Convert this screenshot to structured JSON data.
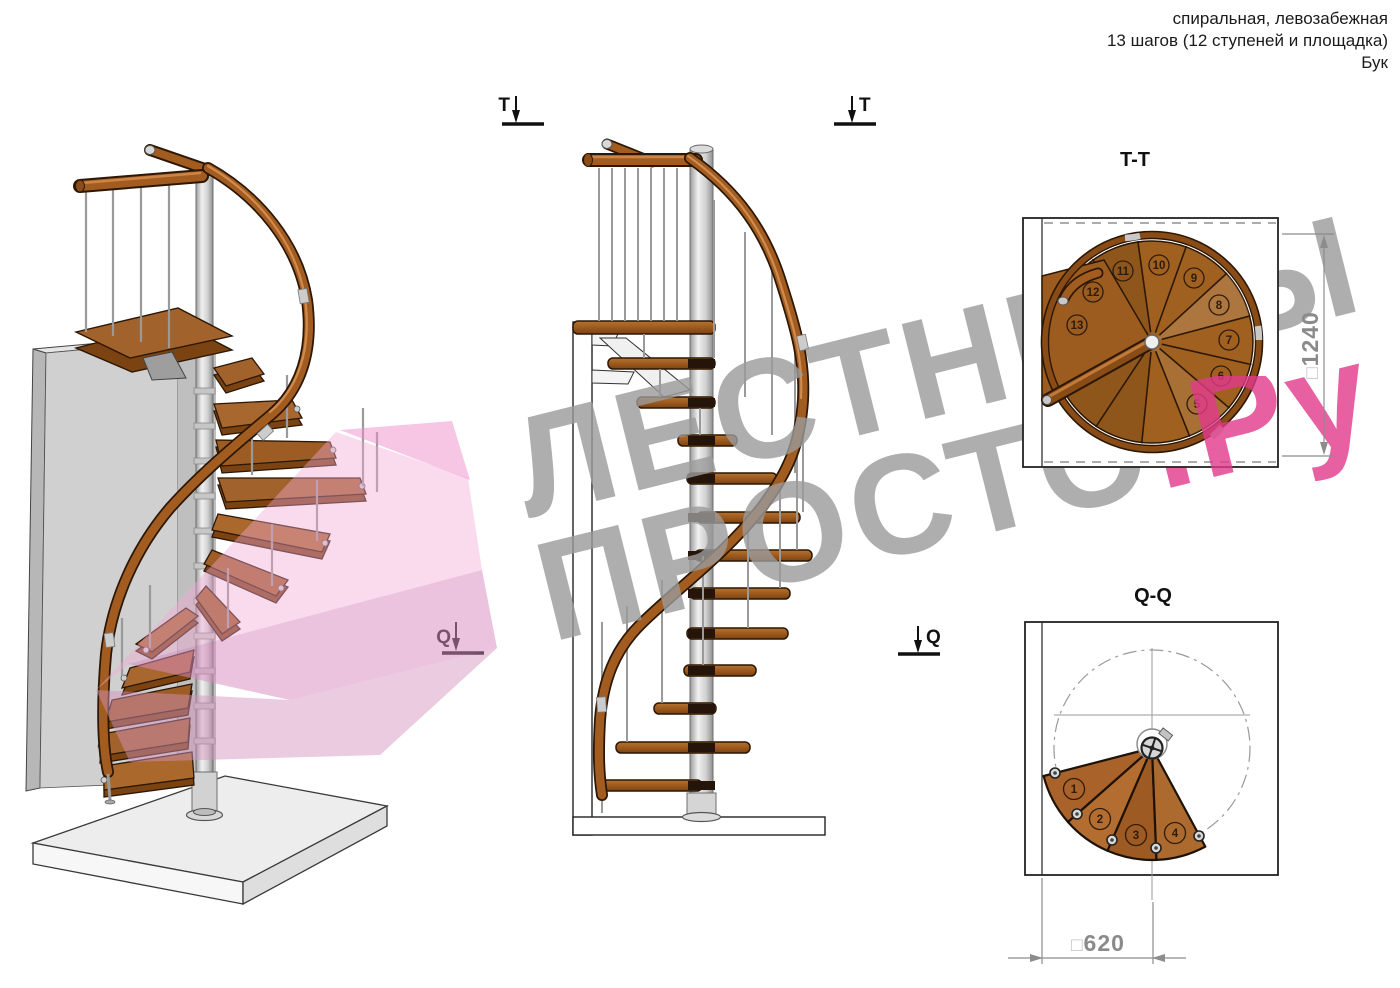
{
  "header": {
    "line1": "спиральная, левозабежная",
    "line2": "13 шагов (12 ступеней и площадка)",
    "line3": "Бук"
  },
  "views": {
    "tt_title": "T-T",
    "qq_title": "Q-Q"
  },
  "markers": {
    "t": "T",
    "q": "Q"
  },
  "dimensions": {
    "square_symbol": "□",
    "tt_value": "1240",
    "qq_value": "620"
  },
  "plan_tt": {
    "step_numbers": [
      "5",
      "6",
      "7",
      "8",
      "9",
      "10",
      "11",
      "12",
      "13"
    ]
  },
  "plan_qq": {
    "step_numbers": [
      "1",
      "2",
      "3",
      "4"
    ]
  },
  "watermark": {
    "line1": "ЛЕСТНИЦЫ",
    "line2_gray": "ПРОСТО",
    "line2_pink": ".Ру",
    "gray_color": "#9b9b9b",
    "pink_color": "#e23a8c"
  }
}
